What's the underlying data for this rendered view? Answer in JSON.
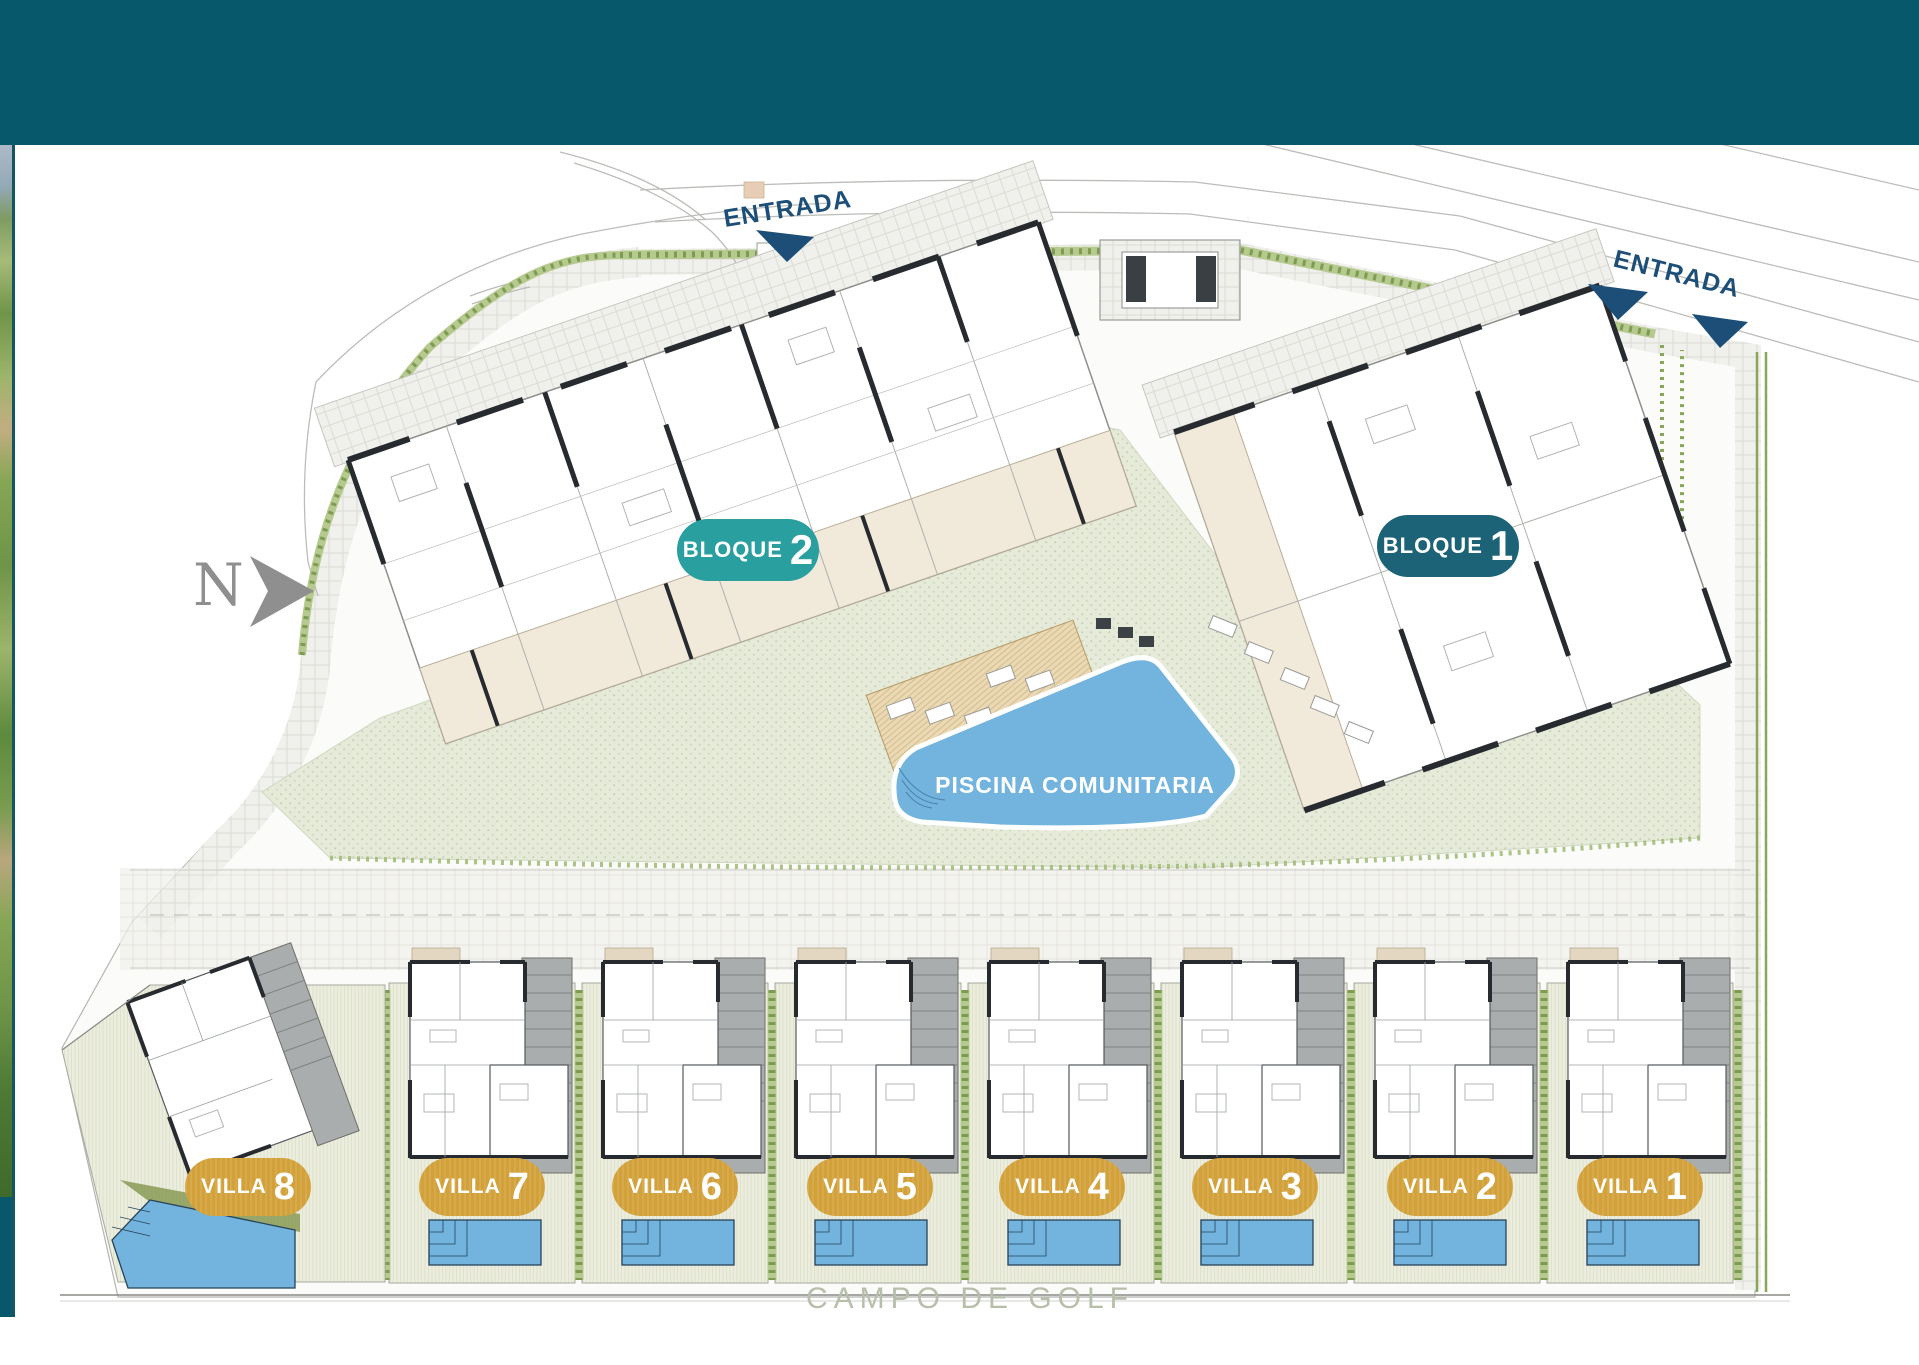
{
  "colors": {
    "header": "#07586a",
    "sideline": "#125663",
    "navy": "#1c4e78",
    "bloque2": "#2a9fa0",
    "bloque1": "#1d6377",
    "gold": "#d2a139",
    "pool": "#72b4dd",
    "campo": "#b7bfab",
    "compass": "#8f8f8f"
  },
  "labels": {
    "entrada_top": "ENTRADA",
    "entrada_right": "ENTRADA",
    "piscina": "PISCINA COMUNITARIA",
    "campo_de_golf": "CAMPO DE GOLF",
    "north": "N"
  },
  "blocks": [
    {
      "label": "BLOQUE",
      "number": "2"
    },
    {
      "label": "BLOQUE",
      "number": "1"
    }
  ],
  "villas": [
    {
      "label": "VILLA",
      "number": "8"
    },
    {
      "label": "VILLA",
      "number": "7"
    },
    {
      "label": "VILLA",
      "number": "6"
    },
    {
      "label": "VILLA",
      "number": "5"
    },
    {
      "label": "VILLA",
      "number": "4"
    },
    {
      "label": "VILLA",
      "number": "3"
    },
    {
      "label": "VILLA",
      "number": "2"
    },
    {
      "label": "VILLA",
      "number": "1"
    }
  ]
}
